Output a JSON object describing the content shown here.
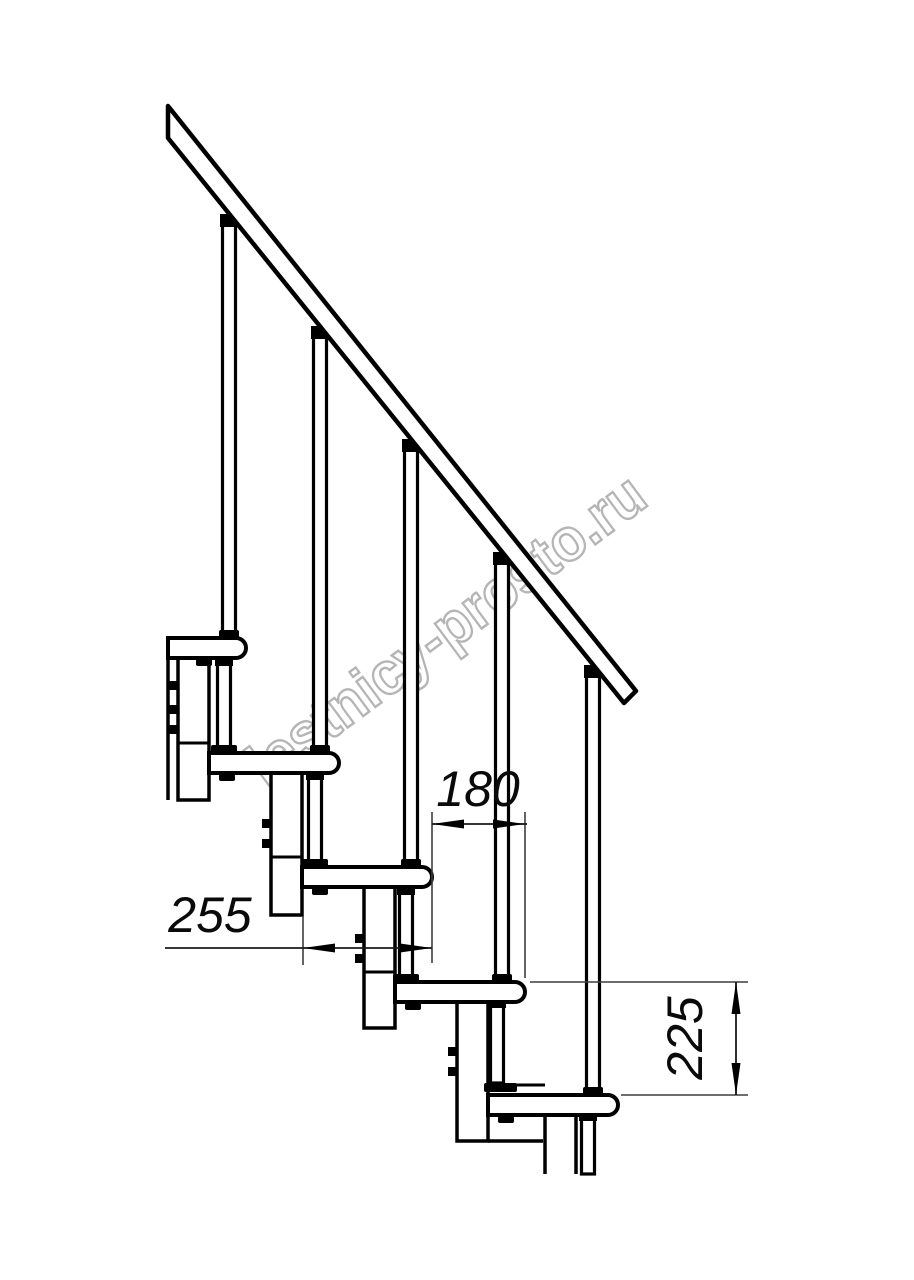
{
  "drawing": {
    "watermark": {
      "text": "lestnicy-prosto.ru",
      "color": "#b5b5b5"
    },
    "dimensions": {
      "tread_depth": {
        "value": "255"
      },
      "step_run": {
        "value": "180"
      },
      "step_rise": {
        "value": "225"
      }
    },
    "colors": {
      "line": "#000000",
      "dim_line": "#3d3d3d",
      "dim_text": "#0a0a0a",
      "background": "#ffffff"
    }
  }
}
